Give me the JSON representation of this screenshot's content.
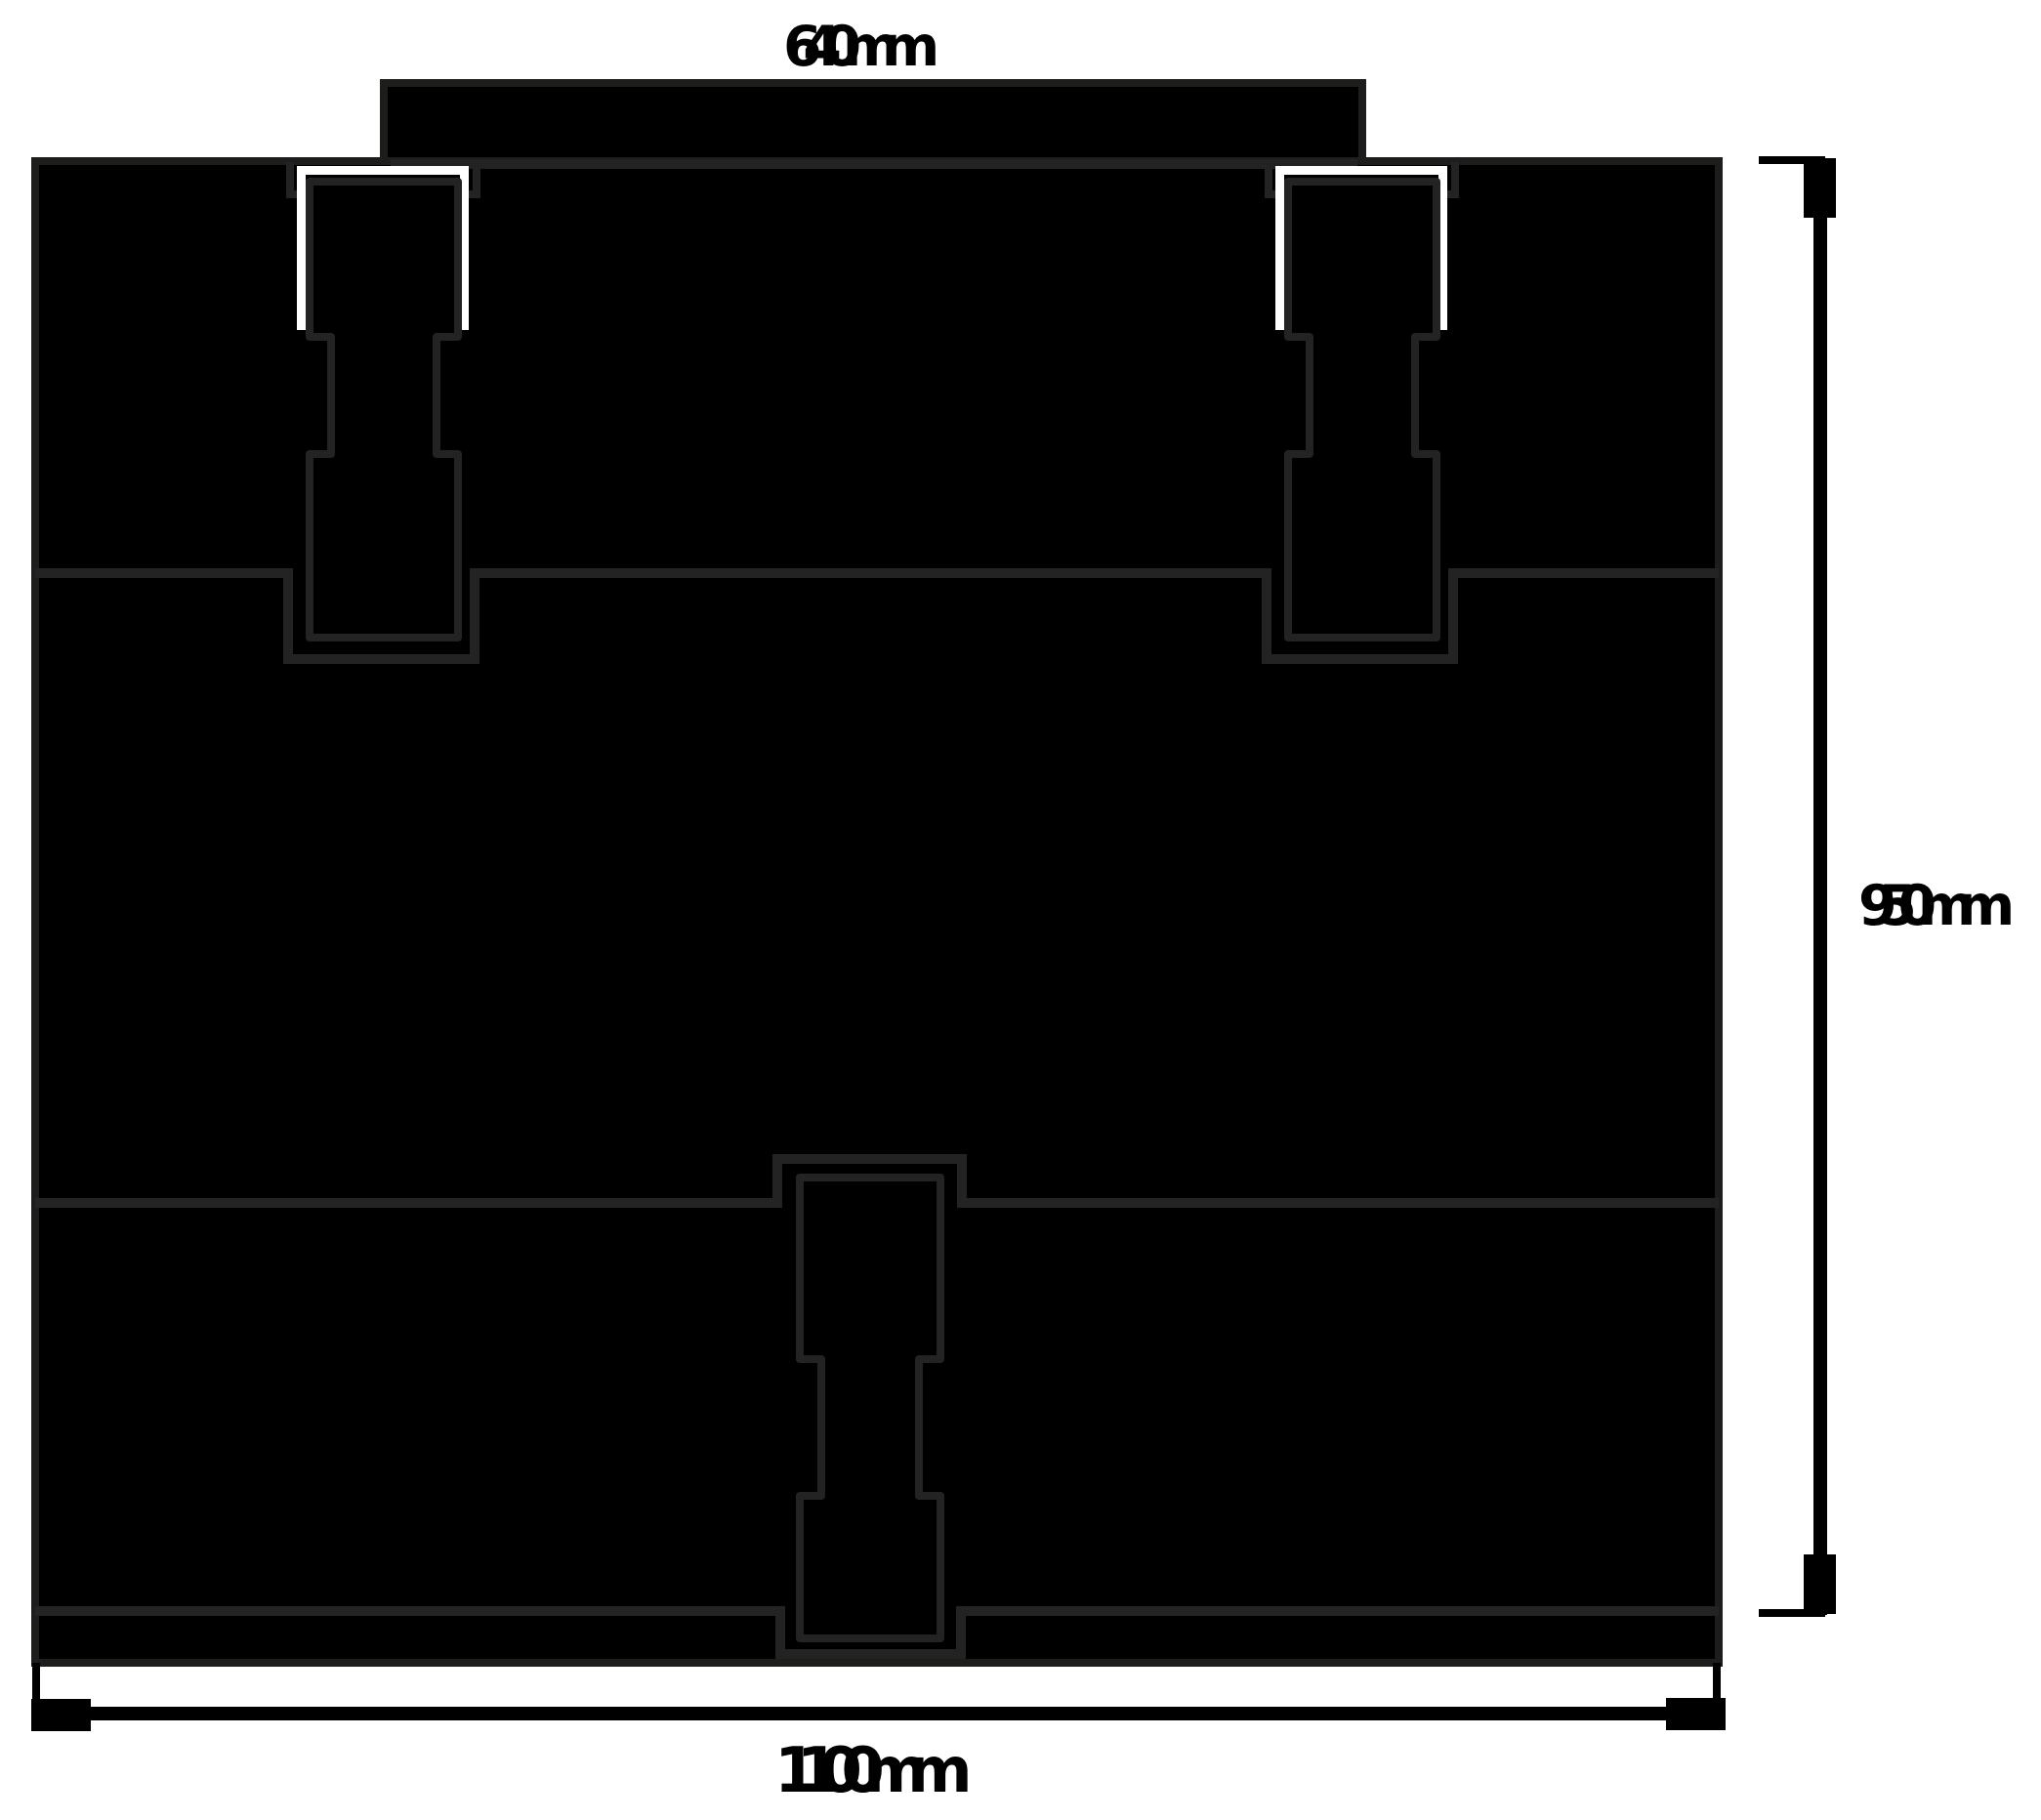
{
  "drawing": {
    "type": "cnc-panel-technical-drawing",
    "dimensions": {
      "top_width_label": "640mm",
      "height_label": "950mm",
      "bottom_width_label": "1100mm"
    },
    "parts": {
      "top_tab": "top mounting tab",
      "top_band": "upper panel",
      "middle_band": "middle panel",
      "bottom_band": "lower panel",
      "bottom_strip": "base strip",
      "connectors": "dogbone connectors (2 top, 1 bottom center)"
    },
    "colors": {
      "panel_fill": "#000000",
      "seam_stroke": "#232323",
      "outline_stroke": "#1d1d1b",
      "kerf_white": "#ffffff",
      "background": "#ffffff",
      "text": "#000000"
    }
  }
}
